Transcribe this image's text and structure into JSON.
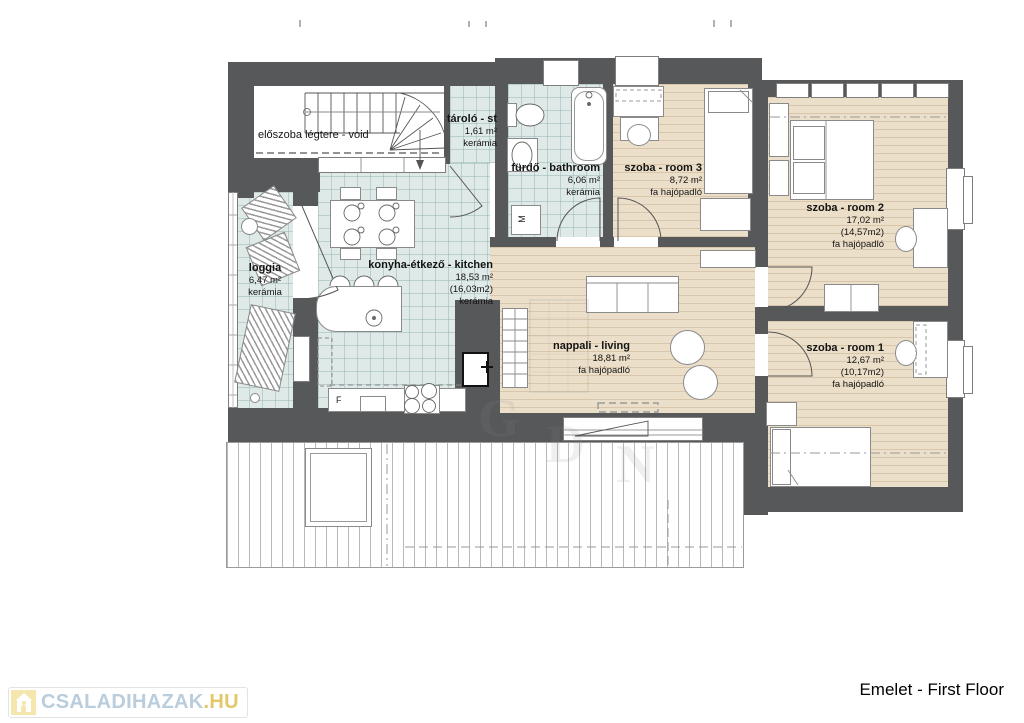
{
  "header": {
    "title": "Emelet - First Floor"
  },
  "logo": {
    "primary": "CSALADIHAZAK",
    "suffix": ".HU"
  },
  "rooms": [
    {
      "id": "void",
      "name": "előszoba légtere - void"
    },
    {
      "id": "storage",
      "name": "tároló - st",
      "area": "1,61 m²",
      "floor": "kerámia"
    },
    {
      "id": "bathroom",
      "name": "fürdő - bathroom",
      "area": "6,06 m²",
      "floor": "kerámia"
    },
    {
      "id": "room3",
      "name": "szoba - room 3",
      "area": "8,72 m²",
      "floor": "fa hajópadló"
    },
    {
      "id": "room2",
      "name": "szoba - room 2",
      "area": "17,02 m²",
      "area_net": "(14,57m2)",
      "floor": "fa hajópadló"
    },
    {
      "id": "loggia",
      "name": "loggia",
      "area": "6,47 m²",
      "floor": "kerámia"
    },
    {
      "id": "kitchen",
      "name": "konyha-étkező - kitchen",
      "area": "18,53 m²",
      "area_net": "(16,03m2)",
      "floor": "kerámia"
    },
    {
      "id": "living",
      "name": "nappali - living",
      "area": "18,81 m²",
      "floor": "fa hajópadló"
    },
    {
      "id": "room1",
      "name": "szoba - room 1",
      "area": "12,67 m²",
      "area_net": "(10,17m2)",
      "floor": "fa hajópadló"
    }
  ],
  "labels": {
    "fridge": "F",
    "washer": "M"
  },
  "watermark_letters": [
    "G",
    "D",
    "N"
  ],
  "colors": {
    "wall": "#57585a",
    "tile_floor": "#dfe9e8",
    "wood_floor": "#ecdfc9",
    "logo_blue": "#b9cddd",
    "logo_gold": "#e3c769"
  }
}
